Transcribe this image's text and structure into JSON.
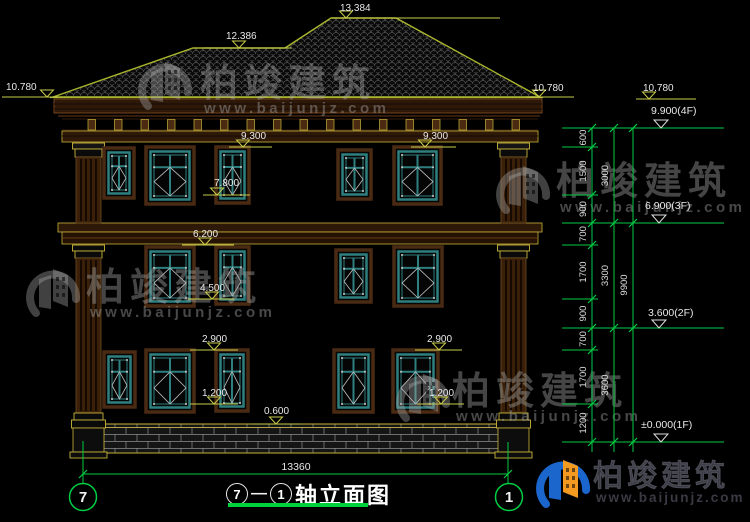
{
  "title_block": {
    "axis_start": "7",
    "separator": "—",
    "axis_end": "1",
    "title": "轴立面图"
  },
  "overall_dim": {
    "value": "13360"
  },
  "axis_bubbles": [
    {
      "label": "7",
      "x": 83
    },
    {
      "label": "1",
      "x": 509
    }
  ],
  "watermark": {
    "brand": "柏竣建筑",
    "url": "www.baijunjz.com"
  },
  "watermark_positions": [
    {
      "ix": 138,
      "iy": 56,
      "tx": 200,
      "ty": 96,
      "ux": 204,
      "uy": 113
    },
    {
      "ix": 496,
      "iy": 160,
      "tx": 556,
      "ty": 194,
      "ux": 560,
      "uy": 212
    },
    {
      "ix": 26,
      "iy": 263,
      "tx": 86,
      "ty": 300,
      "ux": 90,
      "uy": 317
    },
    {
      "ix": 396,
      "iy": 368,
      "tx": 452,
      "ty": 404,
      "ux": 456,
      "uy": 421
    }
  ],
  "footer_logo": {
    "ix": 536,
    "iy": 454,
    "tx": 593,
    "ty": 486,
    "ux": 596,
    "uy": 502
  },
  "elevation_markers": [
    {
      "v": "13.384",
      "tx": 340,
      "ty": 13,
      "x1": 332,
      "x2": 500,
      "y": 18,
      "tri": 346
    },
    {
      "v": "12.386",
      "tx": 226,
      "ty": 41,
      "x1": 204,
      "x2": 292,
      "y": 48,
      "tri": 239
    },
    {
      "v": "10.780",
      "tx": 6,
      "ty": 92,
      "x1": 2,
      "x2": 58,
      "y": 97,
      "tri": 47
    },
    {
      "v": "10.780",
      "tx": 533,
      "ty": 93,
      "x1": 527,
      "x2": 574,
      "y": 97,
      "tri": 539
    },
    {
      "v": "10.780",
      "tx": 643,
      "ty": 93,
      "x1": 636,
      "x2": 696,
      "y": 99,
      "tri": 649
    },
    {
      "v": "9.300",
      "tx": 241,
      "ty": 141,
      "x1": 229,
      "x2": 272,
      "y": 147,
      "tri": 243
    },
    {
      "v": "9.300",
      "tx": 423,
      "ty": 141,
      "x1": 411,
      "x2": 456,
      "y": 147,
      "tri": 425
    },
    {
      "v": "7.800",
      "tx": 214,
      "ty": 188,
      "x1": 203,
      "x2": 250,
      "y": 195,
      "tri": 217
    },
    {
      "v": "6.200",
      "tx": 193,
      "ty": 239,
      "x1": 182,
      "x2": 234,
      "y": 245,
      "tri": 205
    },
    {
      "v": "4.500",
      "tx": 200,
      "ty": 293,
      "x1": 188,
      "x2": 234,
      "y": 299,
      "tri": 212
    },
    {
      "v": "2.900",
      "tx": 202,
      "ty": 344,
      "x1": 190,
      "x2": 238,
      "y": 350,
      "tri": 214
    },
    {
      "v": "2.900",
      "tx": 427,
      "ty": 344,
      "x1": 415,
      "x2": 462,
      "y": 350,
      "tri": 439
    },
    {
      "v": "1.200",
      "tx": 202,
      "ty": 398,
      "x1": 190,
      "x2": 238,
      "y": 404,
      "tri": 214
    },
    {
      "v": "1.200",
      "tx": 429,
      "ty": 398,
      "x1": 417,
      "x2": 464,
      "y": 404,
      "tri": 441
    },
    {
      "v": "0.600",
      "tx": 264,
      "ty": 416,
      "x1": 252,
      "x2": 300,
      "y": 424,
      "tri": 276
    }
  ],
  "floor_markers": [
    {
      "label": "9.900(4F)",
      "y": 128,
      "tx": 651,
      "ty": 114,
      "tri": 661
    },
    {
      "label": "6.900(3F)",
      "y": 223,
      "tx": 645,
      "ty": 209,
      "tri": 659
    },
    {
      "label": "3.600(2F)",
      "y": 328,
      "tx": 648,
      "ty": 316,
      "tri": 659
    },
    {
      "label": "±0.000(1F)",
      "y": 442,
      "tx": 641,
      "ty": 428,
      "tri": 661
    }
  ],
  "dim_chain": {
    "boundaries_y": [
      128,
      147,
      195,
      223,
      245,
      299,
      328,
      350,
      404,
      442
    ],
    "segments": [
      "600",
      "1500",
      "900",
      "700",
      "1700",
      "900",
      "700",
      "1700",
      "1200"
    ],
    "subtotals": [
      {
        "v": "3000",
        "y1": 128,
        "y2": 223
      },
      {
        "v": "3300",
        "y1": 223,
        "y2": 328
      },
      {
        "v": "3600",
        "y1": 328,
        "y2": 442
      }
    ],
    "total": {
      "v": "9900",
      "y1": 128,
      "y2": 442
    },
    "majors": [
      128,
      223,
      328,
      442
    ]
  },
  "windows": [
    {
      "x": 104,
      "y": 148,
      "w": 30,
      "h": 50
    },
    {
      "x": 146,
      "y": 147,
      "w": 48,
      "h": 57
    },
    {
      "x": 216,
      "y": 147,
      "w": 33,
      "h": 56
    },
    {
      "x": 338,
      "y": 150,
      "w": 33,
      "h": 49
    },
    {
      "x": 394,
      "y": 147,
      "w": 47,
      "h": 57
    },
    {
      "x": 146,
      "y": 247,
      "w": 48,
      "h": 59
    },
    {
      "x": 216,
      "y": 247,
      "w": 33,
      "h": 57
    },
    {
      "x": 336,
      "y": 250,
      "w": 35,
      "h": 52
    },
    {
      "x": 394,
      "y": 247,
      "w": 48,
      "h": 59
    },
    {
      "x": 104,
      "y": 352,
      "w": 31,
      "h": 55
    },
    {
      "x": 146,
      "y": 350,
      "w": 48,
      "h": 62
    },
    {
      "x": 216,
      "y": 350,
      "w": 32,
      "h": 61
    },
    {
      "x": 334,
      "y": 350,
      "w": 39,
      "h": 62
    },
    {
      "x": 393,
      "y": 350,
      "w": 45,
      "h": 62
    }
  ],
  "colors": {
    "green": "#00cc44",
    "cad_yellow": "#c8cc4a",
    "olive": "#a9b52c",
    "teal": "#2e7f7f",
    "brown_trim": "#4a2a12",
    "gold": "#c8b43a",
    "white_text": "#e8e8e8",
    "logo_blue": "#1a66cc",
    "logo_orange": "#f49a20",
    "watermark_gray": "rgba(170,170,170,0.38)"
  }
}
